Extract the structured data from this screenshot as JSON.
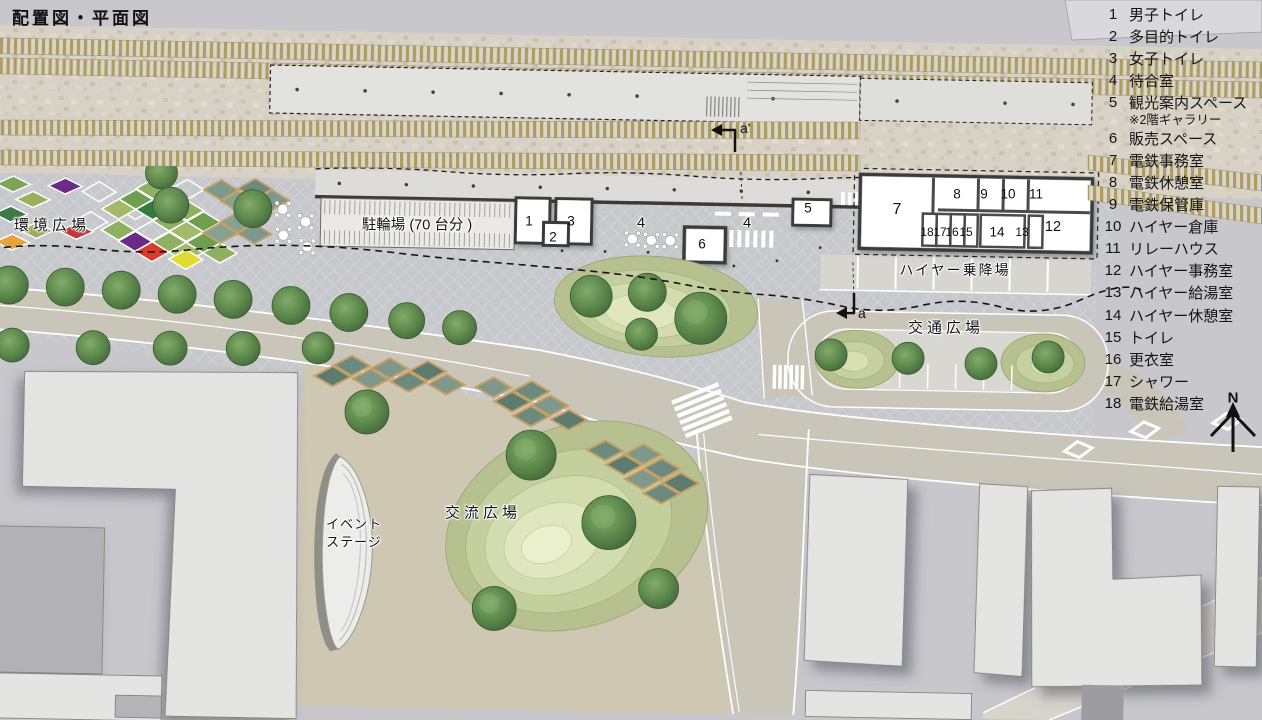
{
  "title": "配置図・平面図",
  "legend": {
    "items": [
      {
        "no": "1",
        "label": "男子トイレ"
      },
      {
        "no": "2",
        "label": "多目的トイレ"
      },
      {
        "no": "3",
        "label": "女子トイレ"
      },
      {
        "no": "4",
        "label": "待合室"
      },
      {
        "no": "5",
        "label": "観光案内スペース",
        "note": "※2階ギャラリー"
      },
      {
        "no": "6",
        "label": "販売スペース"
      },
      {
        "no": "7",
        "label": "電鉄事務室"
      },
      {
        "no": "8",
        "label": "電鉄休憩室"
      },
      {
        "no": "9",
        "label": "電鉄保管庫"
      },
      {
        "no": "10",
        "label": "ハイヤー倉庫"
      },
      {
        "no": "11",
        "label": "リレーハウス"
      },
      {
        "no": "12",
        "label": "ハイヤー事務室"
      },
      {
        "no": "13",
        "label": "ハイヤー給湯室"
      },
      {
        "no": "14",
        "label": "ハイヤー休憩室"
      },
      {
        "no": "15",
        "label": "トイレ"
      },
      {
        "no": "16",
        "label": "更衣室"
      },
      {
        "no": "17",
        "label": "シャワー"
      },
      {
        "no": "18",
        "label": "電鉄給湯室"
      }
    ]
  },
  "map_labels": {
    "environment_plaza": "環境広場",
    "bicycle_parking": "駐輪場 (70 台分 )",
    "hire_taxi_stand": "ハイヤー乗降場",
    "traffic_plaza": "交通広場",
    "exchange_plaza": "交流広場",
    "event_stage_line1": "イベント",
    "event_stage_line2": "ステージ",
    "section_a_prime": "a'",
    "section_a": "a",
    "north": "N"
  },
  "rooms": {
    "r1": "1",
    "r2": "2",
    "r3": "3",
    "r5": "5",
    "r6": "6",
    "r7": "7",
    "r8": "8",
    "r9": "9",
    "r10": "10",
    "r11": "11",
    "r12": "12",
    "r13": "13",
    "r14": "14",
    "r15": "15",
    "r16": "16",
    "r17": "17",
    "r18": "18",
    "waiting_a": "4",
    "waiting_b": "4"
  },
  "colors": {
    "track_tan": "#ab9d64",
    "gravel": "#d8d2c6",
    "paving": "#c6c8cc",
    "road": "#c9c6b9",
    "plaza_tan": "#cec8b2",
    "mound_green": "#b6c18f",
    "tree_green": "#5d8a4c",
    "skylight_teal": "#6d8a7e",
    "frame_tan": "#c6a066",
    "accent_purple": "#6a2a86",
    "accent_red": "#c23b30",
    "accent_orange": "#e6a33c",
    "accent_yellow": "#dedc30"
  }
}
